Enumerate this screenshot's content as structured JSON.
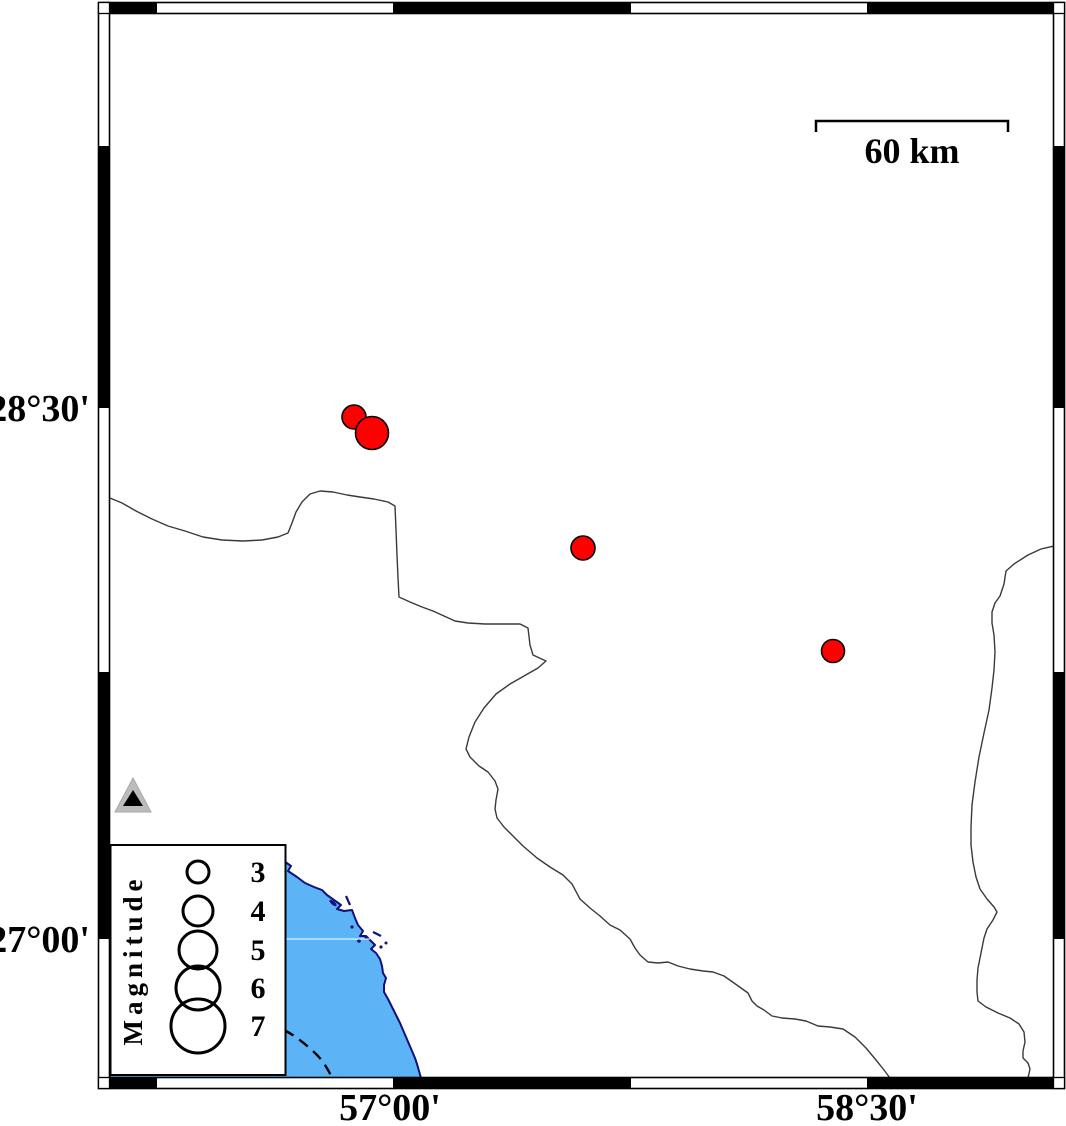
{
  "figure": {
    "type": "seismicity-map",
    "description": "Epicenter map with fancy GMT-style frame, coastline, magnitude legend and scale bar"
  },
  "axis": {
    "left": [
      {
        "label": "28°30'",
        "y": 408
      },
      {
        "label": "27°00'",
        "y": 939
      }
    ],
    "bottom": [
      {
        "label": "57°00'",
        "x": 390
      },
      {
        "label": "58°30'",
        "x": 867
      }
    ]
  },
  "scale_bar": {
    "label": "60 km",
    "length_km": 60,
    "x1": 816,
    "x2": 1008,
    "y": 121
  },
  "legend": {
    "title": "Magnitude",
    "circle_cx": 198,
    "label_x": 258,
    "entries": [
      {
        "label": "3",
        "cy": 872,
        "r": 11
      },
      {
        "label": "4",
        "cy": 911,
        "r": 15
      },
      {
        "label": "5",
        "cy": 950,
        "r": 19
      },
      {
        "label": "6",
        "cy": 988,
        "r": 22
      },
      {
        "label": "7",
        "cy": 1026,
        "r": 27
      }
    ]
  },
  "epicenters": [
    {
      "x": 354,
      "y": 417,
      "r": 12,
      "lon": "56°53'E",
      "lat": "28°28'N",
      "approx_magnitude": 3.4
    },
    {
      "x": 372,
      "y": 433,
      "r": 16.5,
      "lon": "56°57'E",
      "lat": "28°26'N",
      "approx_magnitude": 4.4
    },
    {
      "x": 583,
      "y": 548,
      "r": 12,
      "lon": "57°36'E",
      "lat": "28°06'N",
      "approx_magnitude": 3.4
    },
    {
      "x": 833,
      "y": 651,
      "r": 11.5,
      "lon": "58°24'E",
      "lat": "27°49'N",
      "approx_magnitude": 3.3
    }
  ],
  "station": {
    "x": 133,
    "y": 797,
    "lon": "56°12'E",
    "lat": "27°24'N"
  },
  "colors": {
    "epicenter": "#ff0000",
    "water": "#5cb3f6",
    "coastline": "#10107e",
    "boundary_line": "#3a3a3a",
    "frame": "#000000",
    "station_gray": "#bcbcbc"
  }
}
